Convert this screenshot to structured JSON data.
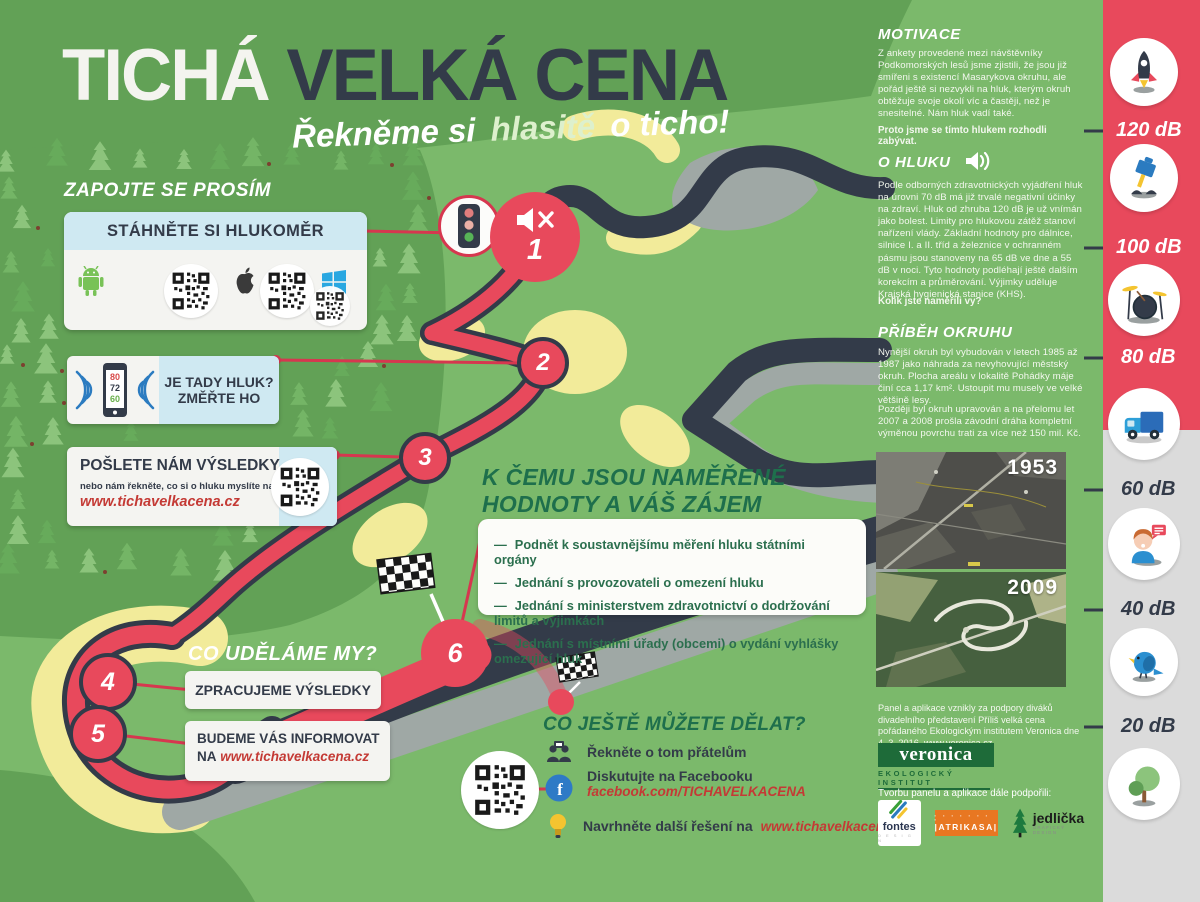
{
  "poster": {
    "title_white": "TICHÁ",
    "title_dark": "VELKÁ CENA",
    "subtitle_1": "Řekněme si",
    "subtitle_2": "hlasitě",
    "subtitle_3": "o ticho!"
  },
  "join": {
    "heading": "ZAPOJTE SE PROSÍM",
    "download_card": {
      "header": "STÁHNĚTE SI HLUKOMĚR",
      "platforms": [
        "android",
        "apple",
        "windows"
      ]
    },
    "measure_card": {
      "line1": "JE TADY HLUK?",
      "line2": "ZMĚŘTE HO",
      "phone_values": [
        "80",
        "72",
        "60"
      ]
    },
    "send_card": {
      "heading": "POŠLETE NÁM VÝSLEDKY",
      "note": "nebo nám řekněte, co si o hluku myslíte na",
      "link": "www.tichavelkacena.cz"
    }
  },
  "we_do": {
    "heading": "CO UDĚLÁME MY?",
    "step4": "ZPRACUJEME VÝSLEDKY",
    "step5_line1": "BUDEME VÁS INFORMOVAT",
    "step5_na": "NA",
    "step5_link": "www.tichavelkacena.cz"
  },
  "purpose": {
    "heading_line1": "K ČEMU JSOU NAMĚŘENÉ",
    "heading_line2": "HODNOTY A VÁŠ ZÁJEM",
    "items": [
      "Podnět k soustavnějšímu měření hluku státními orgány",
      "Jednání s provozovateli o omezení hluku",
      "Jednání s ministerstvem zdravotnictví o dodržování limitů a výjimkách",
      "Jednání s místními úřady (obcemi) o vydání vyhlášky omezující hluk"
    ]
  },
  "more": {
    "heading": "CO JEŠTĚ MŮŽETE DĚLAT?",
    "item1": "Řekněte o tom přátelům",
    "item2": "Diskutujte na Facebooku",
    "item2_link": "facebook.com/TICHAVELKACENA",
    "item3": "Navrhněte další řešení na",
    "item3_link": "www.tichavelkacena.cz"
  },
  "motivace": {
    "heading": "MOTIVACE",
    "body": "Z ankety provedené mezi návštěvníky Podkomorských lesů jsme zjistili, že jsou již smířeni s existencí Masarykova okruhu, ale pořád ještě si nezvykli na hluk, kterým okruh obtěžuje svoje okolí víc a častěji, než je snesitelné. Nám hluk vadí také.",
    "bold": "Proto jsme se tímto hlukem rozhodli zabývat."
  },
  "o_hluku": {
    "heading": "O HLUKU",
    "body": "Podle odborných zdravotnických vyjádření hluk na úrovni 70 dB má již trvalé negativní účinky na zdraví. Hluk od zhruba 120 dB je už vnímán jako bolest. Limity pro hlukovou zátěž stanoví nařízení vlády. Základní hodnoty pro dálnice, silnice I. a II. tříd a železnice v ochranném pásmu jsou stanoveny na 65 dB ve dne a 55 dB v noci. Tyto hodnoty podléhají ještě dalším korekcím a průměrování. Výjimky uděluje Krajská hygienická stanice (KHS).",
    "bold": "Kolik jste naměřili vy?"
  },
  "pribeh": {
    "heading": "PŘÍBĚH OKRUHU",
    "p1": "Nynější okruh byl vybudován v letech 1985 až 1987 jako náhrada za nevyhovující městský okruh. Plocha areálu v lokalitě Pohádky máje činí cca 1,17 km². Ustoupit mu musely ve velké většině lesy.",
    "p2": "Později byl okruh upravován a na přelomu let 2007 a 2008 prošla závodní dráha kompletní výměnou povrchu trati za více než 150 mil. Kč.",
    "photo1_year": "1953",
    "photo2_year": "2009"
  },
  "credits": {
    "text": "Panel a aplikace vznikly za podpory diváků divadelního představení Příliš velká cena pořádaného Ekologickým institutem Veronica dne 4. 3. 2016. www.veronica.cz",
    "veronica_name": "veronica",
    "veronica_sub": "EKOLOGICKÝ INSTITUT",
    "supporters_label": "Tvorbu panelu a aplikace dále podpořili:",
    "logo1": "fontes",
    "logo2": "ATRIKASA",
    "logo3": "jedlička",
    "logo3_sub": "GRAFICKÝ DESIGN"
  },
  "scale": {
    "labels": [
      "120 dB",
      "100 dB",
      "80 dB",
      "60 dB",
      "40 dB",
      "20 dB"
    ],
    "icons": [
      "rocket-icon",
      "jackhammer-icon",
      "drums-icon",
      "truck-icon",
      "talking-person-icon",
      "bird-icon",
      "tree-icon"
    ]
  },
  "markers": {
    "m1": "1",
    "m2": "2",
    "m3": "3",
    "m4": "4",
    "m5": "5",
    "m6": "6"
  },
  "colors": {
    "red": "#e8495c",
    "navy": "#333b49",
    "green_bg": "#7bb96b",
    "green_dark": "#62a156",
    "heading_green": "#1e6f4c",
    "light_blue": "#cfe9f2",
    "yellow": "#f2eb9a",
    "gray_track": "#9fa8a5",
    "link_red": "#c43a35",
    "sidebar_gray": "#dbdbdb"
  }
}
